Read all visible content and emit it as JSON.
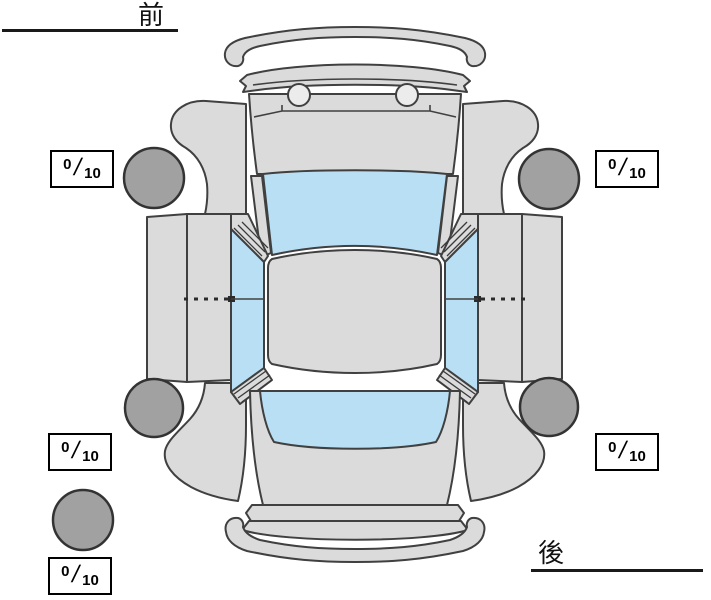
{
  "labels": {
    "front": "前",
    "rear": "後"
  },
  "tire_ratings": {
    "separator": "/",
    "front_left": {
      "value": "0",
      "max": "10"
    },
    "front_right": {
      "value": "0",
      "max": "10"
    },
    "rear_left": {
      "value": "0",
      "max": "10"
    },
    "rear_right": {
      "value": "0",
      "max": "10"
    },
    "spare": {
      "value": "0",
      "max": "10"
    }
  },
  "colors": {
    "background": "#FFFFFF",
    "body_panel": "#DBDBDB",
    "glass": "#B9DFF4",
    "tire": "#A1A1A1",
    "outline": "#404040",
    "box_border": "#000000",
    "text": "#111111"
  }
}
